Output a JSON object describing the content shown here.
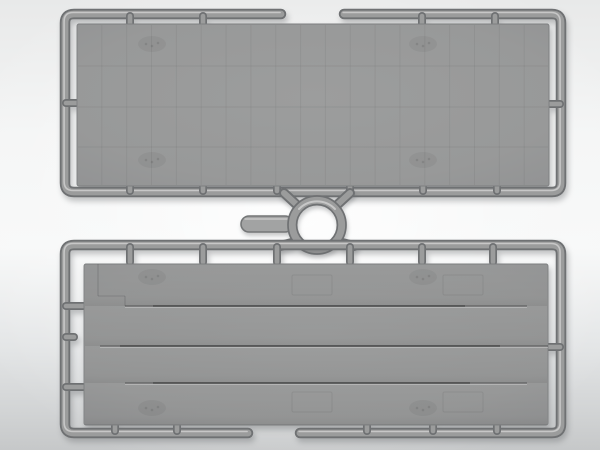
{
  "image": {
    "description": "Photo render of a grey injection-molded model kit sprue: two rectangular flat panels in runner frames connected by a circular ring runner with a flat tab",
    "width": 600,
    "height": 450
  },
  "palette": {
    "rail_edge": "#6f7173",
    "rail_core": "#9b9c9c",
    "rail_sheen": "rgba(255,255,255,0.55)",
    "panel_edge": "#7d7f80",
    "bar_fill": "#a2a3a3",
    "bar_edge": "#747677",
    "bg_top": "#e8e9e9",
    "bg_mid": "#f7f8f8",
    "bg_bottom": "#c6c8c9"
  },
  "scene": {
    "top_sprue": {
      "frame": {
        "x1": 65,
        "y1": 14,
        "x2": 561,
        "y2": 192,
        "r": 9,
        "gap_start": 281,
        "gap_end": 344
      },
      "panel": {
        "x": 77,
        "y": 24,
        "w": 472,
        "h": 162,
        "rx": 2
      },
      "top_tabs": [
        130,
        203,
        422,
        495
      ],
      "bottom_tabs": [
        130,
        203,
        277,
        350,
        423,
        497
      ],
      "left_tab": {
        "x1": 66,
        "x2": 80,
        "y": 103
      },
      "right_tab": {
        "x1": 546,
        "x2": 560,
        "y": 104
      },
      "grid": {
        "cols": 19,
        "row_lines": [
          66,
          107,
          147
        ]
      },
      "smudges": [
        [
          152,
          44
        ],
        [
          423,
          44
        ],
        [
          152,
          160
        ],
        [
          423,
          160
        ]
      ]
    },
    "connector": {
      "ring": {
        "cx": 317,
        "cy": 225,
        "outer_r": 29,
        "inner_r": 20.4,
        "core_r": 24.7,
        "wall": 8.6
      },
      "bar": {
        "x": 241,
        "y": 216,
        "w": 52,
        "h": 16,
        "rx": 8
      },
      "struts": [
        [
          297,
          205,
          284,
          193
        ],
        [
          337,
          205,
          350,
          193
        ],
        [
          292,
          243,
          280,
          246
        ],
        [
          342,
          243,
          354,
          246
        ]
      ]
    },
    "bottom_sprue": {
      "frame": {
        "x1": 65,
        "y1": 245,
        "x2": 561,
        "y2": 433,
        "r": 9,
        "gap_start": 248,
        "gap_end": 300
      },
      "panel": {
        "x": 84,
        "y": 264,
        "w": 464,
        "h": 161,
        "rx": 2
      },
      "top_tabs": [
        130,
        203,
        277,
        350,
        422,
        493
      ],
      "bottom_tabs": [
        115,
        177,
        367,
        433,
        497
      ],
      "left_tabs": [
        {
          "x1": 66,
          "x2": 85,
          "y": 306
        },
        {
          "x1": 66,
          "x2": 74,
          "y": 337
        },
        {
          "x1": 66,
          "x2": 85,
          "y": 387
        }
      ],
      "right_tab": {
        "x1": 547,
        "x2": 560,
        "y": 347
      },
      "grooves": [
        {
          "y": 306,
          "x1": 125,
          "x2": 527,
          "dark": [
            153,
            465
          ]
        },
        {
          "y": 346,
          "x1": 100,
          "x2": 548,
          "dark": [
            120,
            500
          ]
        },
        {
          "y": 383,
          "x1": 125,
          "x2": 527,
          "dark": [
            153,
            470
          ]
        }
      ],
      "band_edges": [
        264,
        306,
        346,
        383,
        425
      ],
      "step_lines": [
        [
          98,
          264,
          98,
          296
        ],
        [
          98,
          296,
          125,
          296
        ],
        [
          125,
          296,
          125,
          306
        ]
      ],
      "hatches": [
        [
          292,
          275,
          40,
          20
        ],
        [
          443,
          275,
          40,
          20
        ],
        [
          292,
          392,
          40,
          20
        ],
        [
          443,
          392,
          40,
          20
        ]
      ],
      "smudges": [
        [
          152,
          277
        ],
        [
          423,
          277
        ],
        [
          152,
          408
        ],
        [
          423,
          408
        ]
      ]
    }
  }
}
